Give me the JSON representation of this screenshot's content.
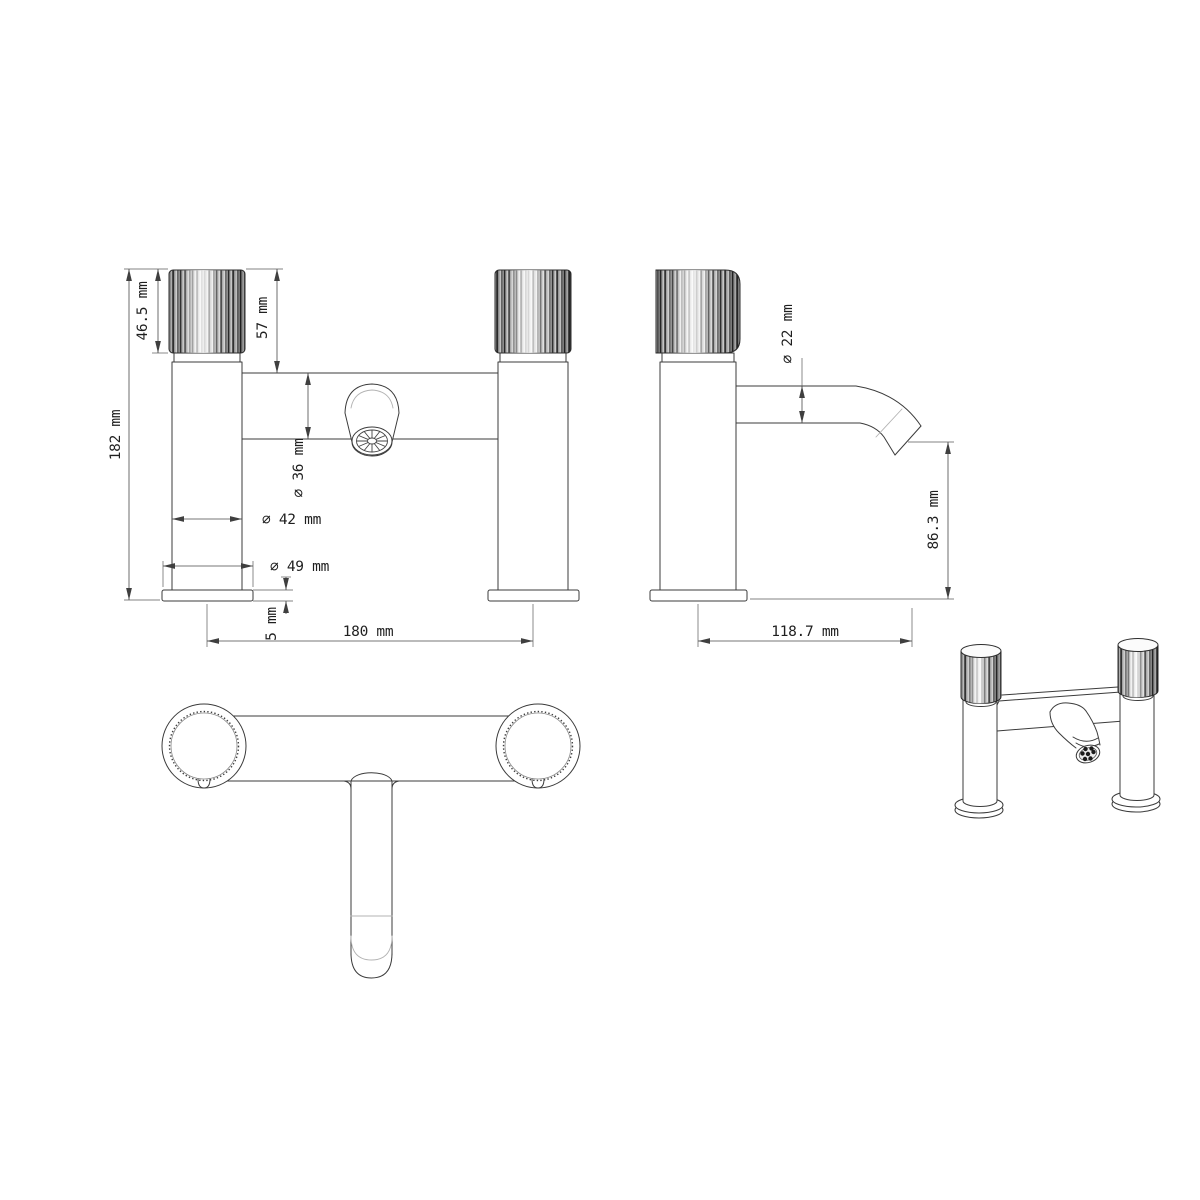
{
  "drawing": {
    "background_color": "#ffffff",
    "line_color": "#3b3b3b",
    "text_color": "#1f1f1f",
    "unit": "mm"
  },
  "front_view": {
    "dimensions": {
      "total_height": "182 mm",
      "handle_height": "46.5 mm",
      "handle_top_to_body": "57 mm",
      "body_diameter": "∅ 36 mm",
      "column_diameter": "∅ 42 mm",
      "base_diameter": "∅ 49 mm",
      "base_plate_height": "5 mm",
      "pillar_centres": "180 mm"
    }
  },
  "side_view": {
    "dimensions": {
      "spout_diameter": "∅ 22 mm",
      "spout_outlet_height": "86.3 mm",
      "spout_reach": "118.7 mm"
    }
  }
}
